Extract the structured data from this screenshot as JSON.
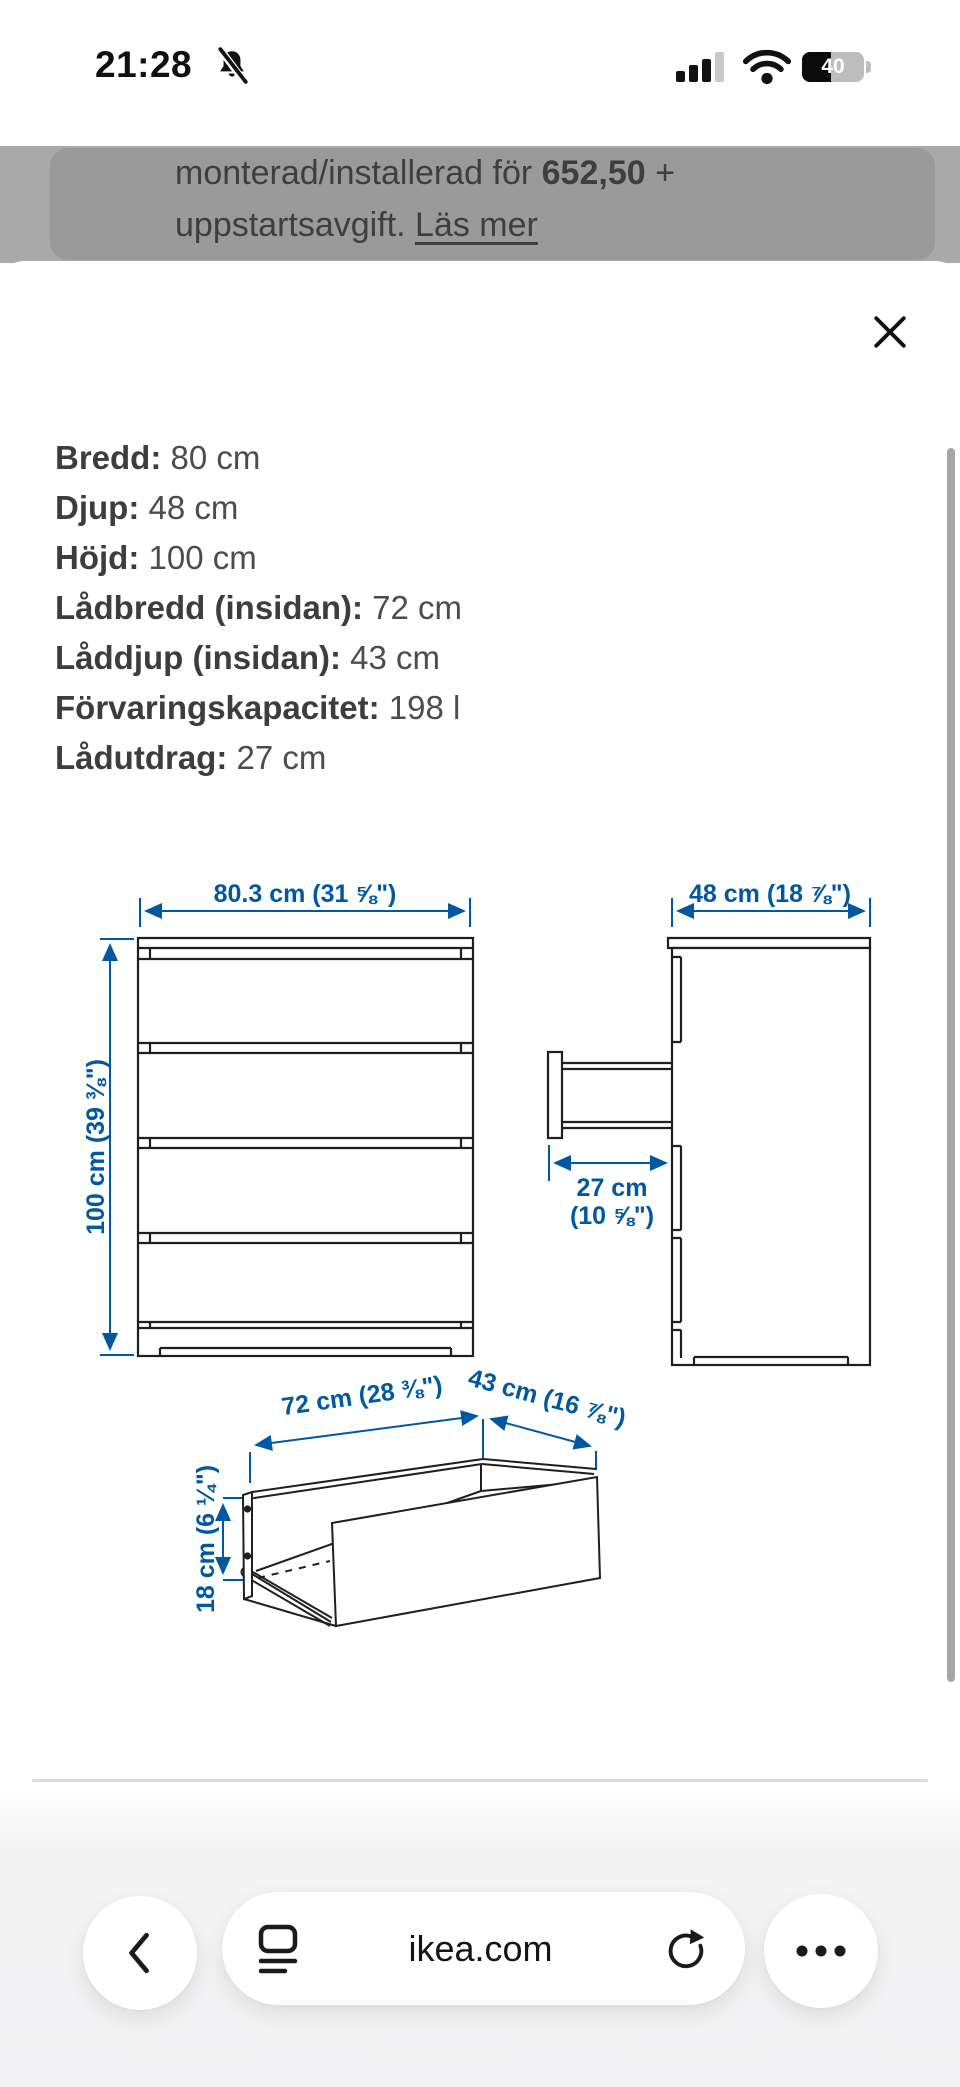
{
  "status_bar": {
    "time": "21:28",
    "battery_percent": "40"
  },
  "background_page": {
    "line1_before": "monterad/installerad för ",
    "line1_price": "652,50",
    "line1_after": " +",
    "line2_text": "uppstartsavgift. ",
    "line2_link": "Läs mer"
  },
  "sheet": {
    "measurements": [
      {
        "label": "Bredd:",
        "value": "80 cm"
      },
      {
        "label": "Djup:",
        "value": "48 cm"
      },
      {
        "label": "Höjd:",
        "value": "100 cm"
      },
      {
        "label": "Lådbredd (insidan):",
        "value": "72 cm"
      },
      {
        "label": "Låddjup (insidan):",
        "value": "43 cm"
      },
      {
        "label": "Förvaringskapacitet:",
        "value": "198 l"
      },
      {
        "label": "Lådutdrag:",
        "value": "27 cm"
      }
    ],
    "diagram": {
      "front_width_label": "80.3 cm (31 ⅝\")",
      "front_height_label": "100 cm (39 ⅜\")",
      "side_depth_label": "48 cm (18 ⅞\")",
      "drawer_extension_label": "27 cm",
      "drawer_extension_sub": "(10 ⅝\")",
      "drawer_width_label": "72 cm (28 ⅜\")",
      "drawer_depth_label": "43 cm (16 ⅞\")",
      "drawer_height_label": "18 cm (6 ¼\")"
    }
  },
  "browser_toolbar": {
    "url": "ikea.com"
  },
  "colors": {
    "accent_blue": "#0058a3",
    "dim_overlay": "#a9a9a9",
    "drawing_line": "#1f1f1f"
  }
}
